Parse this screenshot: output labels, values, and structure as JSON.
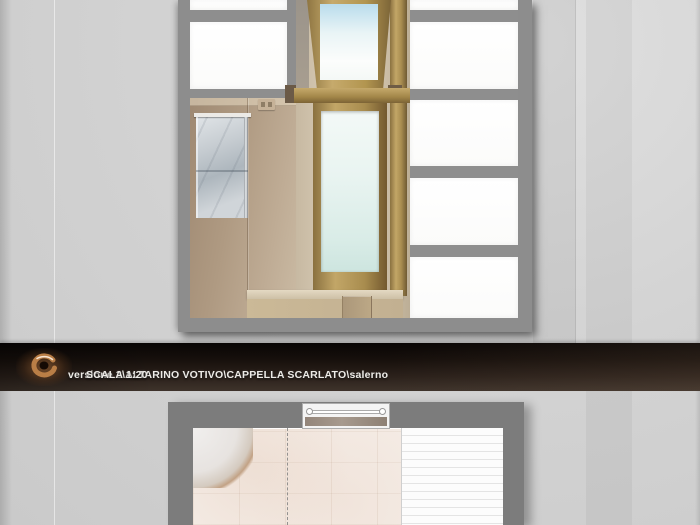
{
  "title_bar": {
    "project_path": "versione 2\\ALTARINO VOTIVO\\CAPPELLA SCARLATO\\salerno",
    "scale_label": "SCALA 1:20",
    "logo_icon": "spiral-swirl-logo",
    "bar_color": "#231a14",
    "text_color": "#edebe7",
    "logo_copper": "#b97e46"
  },
  "colors": {
    "page_background": "#d2d2d2",
    "viewport_frame_gray": "#8d8d8d",
    "marble_wall_beige": "#b3a089",
    "window_wood": "#ab9054",
    "glass_tint": "#dcefe9",
    "backlit_panel_white": "#fcfcfc",
    "altar_slab_marble": "#c6ccd1",
    "plan_wall_gray": "#7c7c7c",
    "plan_floor_pink": "#f4ebe4"
  }
}
